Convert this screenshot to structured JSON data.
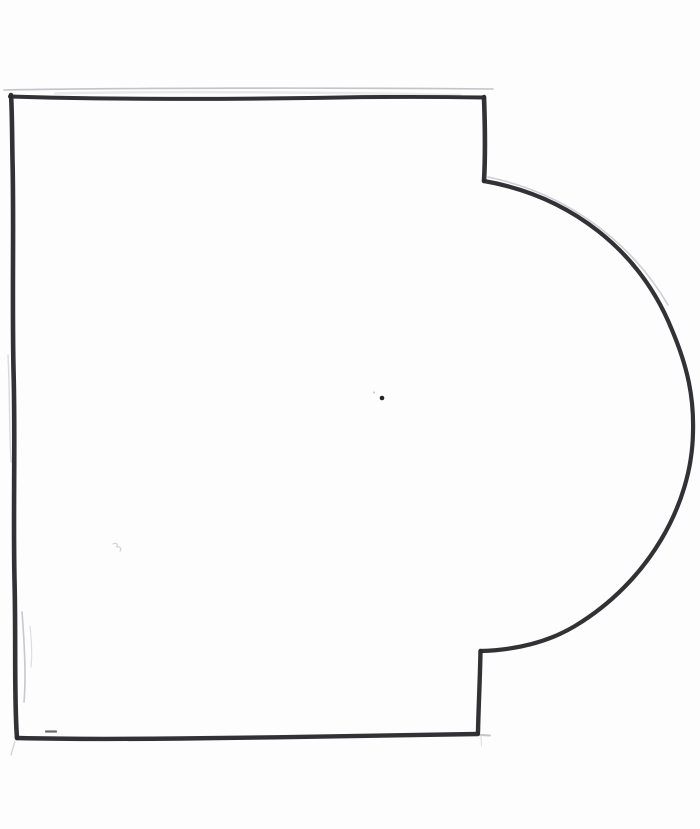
{
  "meta": {
    "description": "Scanned hand-drawn outline sketch: rectangle with semicircular bulge on right side (mug / D-shape template)",
    "paper_color": "#fdfdfd",
    "canvas_width": 700,
    "canvas_height": 829
  },
  "drawing": {
    "ink_color": "#2b2b2f",
    "ink_width": 4.2,
    "pencil_color": "#c3c3c9",
    "pencil_width": 1.5,
    "outline_segments": [
      {
        "name": "top-edge-line",
        "d": "M 10 96.5 C 120 100 260 99 340 97.5 C 400 96.5 450 97 484 97.5",
        "width": 4.0
      },
      {
        "name": "right-notch-top-line",
        "d": "M 484 97 C 485 125 485.5 155 484 181",
        "width": 4.6
      },
      {
        "name": "bulge-arc-line",
        "d": "M 484 181 C 570 196 640 250 672 330 C 688 368 694 398 693 432 C 692 505 648 582 575 626 C 545 644 512 650 481 651",
        "width": 4.2
      },
      {
        "name": "right-notch-bottom-line",
        "d": "M 480.5 651 C 480 678 478.5 708 478 732",
        "width": 4.4
      },
      {
        "name": "bottom-edge-line",
        "d": "M 478 734 C 390 735.5 280 737.5 180 738.5 C 110 739.2 50 738.8 17 738",
        "width": 4.4
      },
      {
        "name": "left-edge-line",
        "d": "M 17 738 C 14 700 16 640 14.5 580 C 13 510 15.5 440 13.5 370 C 12 300 14 220 12.5 160 C 12 130 12 108 11 95",
        "width": 4.6
      }
    ],
    "pencil_guides": [
      {
        "name": "top-pencil-guide",
        "d": "M 4 90 C 120 88 320 87.5 493 89",
        "width": 1.6,
        "color": "#b9b9bf",
        "opacity": 0.85
      },
      {
        "name": "top-pencil-smear",
        "d": "M 55 93.5 C 160 91 300 92 460 95",
        "width": 2.5,
        "color": "#d8d8dc",
        "opacity": 0.55
      },
      {
        "name": "bulge-upper-pencil-guide",
        "d": "M 488 177 C 565 193 630 240 668 305",
        "width": 1.6,
        "color": "#c3c3c9",
        "opacity": 0.8
      },
      {
        "name": "bulge-lower-pencil-guide",
        "d": "M 692 462 C 676 548 612 612 546 640",
        "width": 1.4,
        "color": "#cfcfd4",
        "opacity": 0.7
      },
      {
        "name": "left-mid-pencil-guide",
        "d": "M 8 355 C 10 395 9 425 11 462",
        "width": 1.4,
        "color": "#cacace",
        "opacity": 0.7
      },
      {
        "name": "left-lower-pencil-guide",
        "d": "M 22 612 C 25 650 26 680 24 702",
        "width": 1.6,
        "color": "#b9b9c0",
        "opacity": 0.8
      },
      {
        "name": "left-lower-pencil-guide-2",
        "d": "M 30 626 C 32 645 32 658 31 667",
        "width": 1.2,
        "color": "#c9c9cd",
        "opacity": 0.6
      },
      {
        "name": "bottom-left-corner-tail",
        "d": "M 15 741 L 11 755",
        "width": 1.4,
        "color": "#c5c5ca",
        "opacity": 0.7
      },
      {
        "name": "bottom-right-corner-tick",
        "d": "M 481 735 L 490 735.5",
        "width": 2.0,
        "color": "#b5b5bb",
        "opacity": 0.8
      },
      {
        "name": "bottom-right-corner-tail",
        "d": "M 481 736 L 481.5 746",
        "width": 1.2,
        "color": "#c5c5ca",
        "opacity": 0.5
      }
    ],
    "marks": [
      {
        "name": "center-ink-dot",
        "kind": "dot",
        "cx": 382,
        "cy": 398,
        "r": 2.3,
        "color": "#23232a",
        "opacity": 1
      },
      {
        "name": "center-faint-speck",
        "kind": "dot",
        "cx": 374,
        "cy": 392.5,
        "r": 1.1,
        "color": "#c9c9cd",
        "opacity": 0.9
      },
      {
        "name": "left-faint-squiggle",
        "kind": "path",
        "d": "M 113 544 C 116 542 119 545 116.5 547 C 120 546 122 549 120 551",
        "width": 1.3,
        "color": "#c9c9cd",
        "opacity": 0.8
      },
      {
        "name": "bottom-edge-smudge",
        "kind": "path",
        "d": "M 46 731.5 L 56 731.5",
        "width": 2.2,
        "color": "#3a3a3e",
        "opacity": 0.75
      }
    ]
  }
}
